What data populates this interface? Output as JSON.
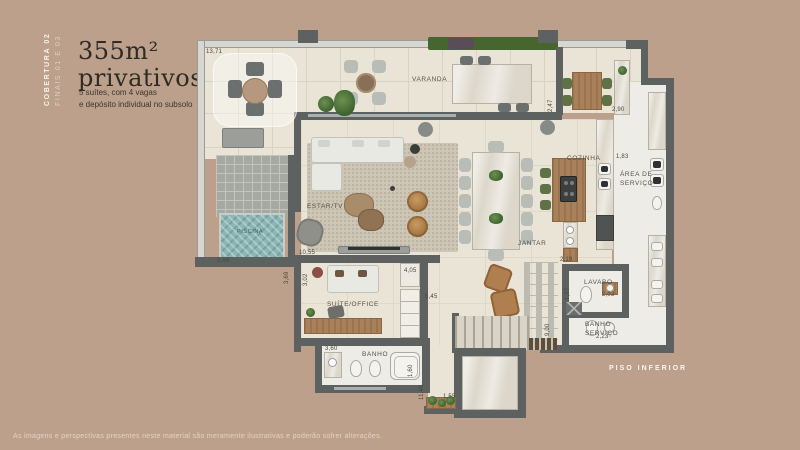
{
  "page": {
    "bg_color": "#bca08b",
    "disclaimer": "As imagens e perspectivas presentes neste material são meramente ilustrativas e poderão sofrer alterações."
  },
  "header": {
    "tag_line1": "COBERTURA 02",
    "tag_line2": "FINAIS 01 E 03",
    "title_line1": "355m²",
    "title_line2": "privativos",
    "subtitle_line1": "5 suítes, com 4 vagas",
    "subtitle_line2": "e depósito individual no subsolo"
  },
  "plan": {
    "floor_label": "PISO INFERIOR",
    "colors": {
      "wall": "#5d6260",
      "floor": "#e9e4d6",
      "pool": "#8cb6b5",
      "deck": "#a6a8a2",
      "wood": "#a8815b",
      "plant_green": "#4e7a3a",
      "leather": "#b5854f"
    },
    "rooms": {
      "varanda": "VARANDA",
      "piscina": "PISCINA",
      "estar": "ESTAR/TV",
      "jantar": "JANTAR",
      "cozinha": "COZINHA",
      "area_servico_1": "ÁREA DE",
      "area_servico_2": "SERVIÇO",
      "suite": "SUÍTE/OFFICE",
      "banho": "BANHO",
      "lavabo": "LAVABO",
      "banho_servico_1": "BANHO",
      "banho_servico_2": "SERVIÇO"
    },
    "dims": [
      "13,71",
      "2,47",
      "2,90",
      "1,83",
      "2,96",
      "10,55",
      "3,02",
      "3,69",
      "4,05",
      "5,45",
      "3,60",
      "1,60",
      "2,19",
      "1,27",
      "2,03",
      "2,23",
      "9,00",
      "11,46",
      "1,55"
    ]
  }
}
